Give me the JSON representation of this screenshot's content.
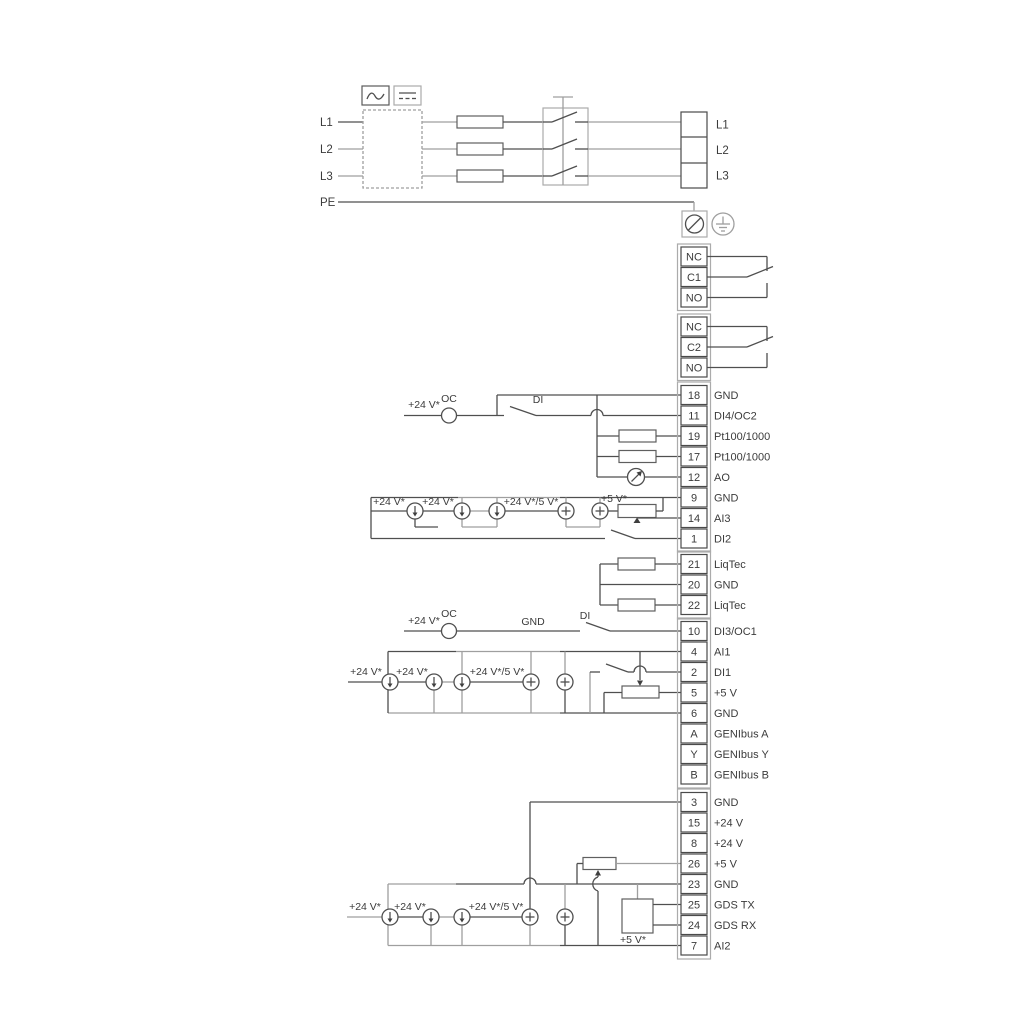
{
  "power": {
    "in": [
      "L1",
      "L2",
      "L3",
      "PE"
    ],
    "out": [
      "L1",
      "L2",
      "L3"
    ],
    "icons": [
      "ac-waveform-icon",
      "dc-lines-icon",
      "earth-ground-icon",
      "pe-terminal-icon"
    ]
  },
  "relays": {
    "r1": [
      "NC",
      "C1",
      "NO"
    ],
    "r2": [
      "NC",
      "C2",
      "NO"
    ]
  },
  "groups": {
    "io2": [
      {
        "num": "18",
        "label": "GND"
      },
      {
        "num": "11",
        "label": "DI4/OC2"
      },
      {
        "num": "19",
        "label": "Pt100/1000"
      },
      {
        "num": "17",
        "label": "Pt100/1000"
      },
      {
        "num": "12",
        "label": "AO"
      },
      {
        "num": "9",
        "label": "GND"
      },
      {
        "num": "14",
        "label": "AI3"
      },
      {
        "num": "1",
        "label": "DI2"
      }
    ],
    "liqtec": [
      {
        "num": "21",
        "label": "LiqTec"
      },
      {
        "num": "20",
        "label": "GND"
      },
      {
        "num": "22",
        "label": "LiqTec"
      }
    ],
    "io1": [
      {
        "num": "10",
        "label": "DI3/OC1"
      },
      {
        "num": "4",
        "label": "AI1"
      },
      {
        "num": "2",
        "label": "DI1"
      },
      {
        "num": "5",
        "label": "+5 V"
      },
      {
        "num": "6",
        "label": "GND"
      },
      {
        "num": "A",
        "label": "GENIbus A"
      },
      {
        "num": "Y",
        "label": "GENIbus Y"
      },
      {
        "num": "B",
        "label": "GENIbus B"
      }
    ],
    "pio": [
      {
        "num": "3",
        "label": "GND"
      },
      {
        "num": "15",
        "label": "+24 V"
      },
      {
        "num": "8",
        "label": "+24 V"
      },
      {
        "num": "26",
        "label": "+5 V"
      },
      {
        "num": "23",
        "label": "GND"
      },
      {
        "num": "25",
        "label": "GDS TX"
      },
      {
        "num": "24",
        "label": "GDS RX"
      },
      {
        "num": "7",
        "label": "AI2"
      }
    ]
  },
  "ann": {
    "di4": {
      "v24": "+24 V*",
      "oc": "OC",
      "di": "DI"
    },
    "ai3": {
      "v24a": "+24 V*",
      "v24b": "+24 V*",
      "v245": "+24 V*/5 V*",
      "v5": "+5 V*"
    },
    "di3": {
      "v24": "+24 V*",
      "oc": "OC",
      "gnd": "GND",
      "di": "DI"
    },
    "ai1": {
      "v24a": "+24 V*",
      "v24b": "+24 V*",
      "v245": "+24 V*/5 V*"
    },
    "ai2": {
      "v24a": "+24 V*",
      "v24b": "+24 V*",
      "v245": "+24 V*/5 V*",
      "v5": "+5 V*"
    }
  },
  "colors": {
    "line_dark": "#4f4f4f",
    "line_gray": "#9f9f9f",
    "text": "#3b3b3b"
  }
}
